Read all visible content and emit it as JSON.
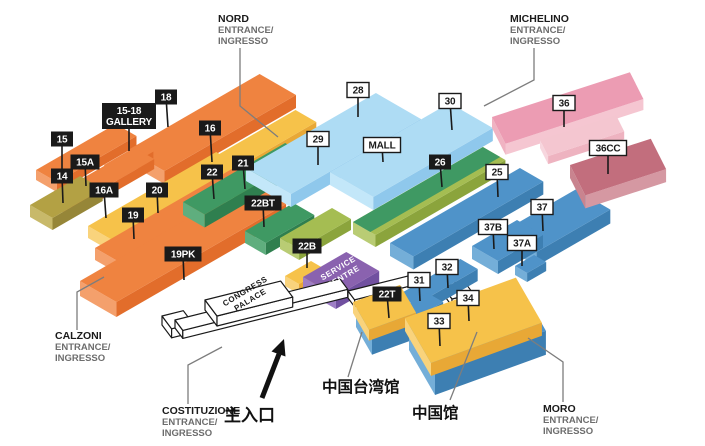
{
  "title": "Exhibition grounds isometric map",
  "halls": {
    "15": "15",
    "15A": "15A",
    "14": "14",
    "16": "16",
    "16A": "16A",
    "18": "18",
    "19": "19",
    "20": "20",
    "19PK": "19PK",
    "22": "22",
    "21": "21",
    "22BT": "22BT",
    "22B": "22B",
    "26": "26",
    "28": "28",
    "29": "29",
    "30": "30",
    "MALL": "MALL",
    "25": "25",
    "36": "36",
    "36CC": "36CC",
    "37": "37",
    "37B": "37B",
    "37A": "37A",
    "31": "31",
    "32": "32",
    "33": "33",
    "34": "34",
    "22T": "22T",
    "GALLERY_L1": "15-18",
    "GALLERY_L2": "GALLERY"
  },
  "entrances": {
    "nord": {
      "name": "NORD",
      "line1": "ENTRANCE/",
      "line2": "INGRESSO"
    },
    "michelino": {
      "name": "MICHELINO",
      "line1": "ENTRANCE/",
      "line2": "INGRESSO"
    },
    "calzoni": {
      "name": "CALZONI",
      "line1": "ENTRANCE/",
      "line2": "INGRESSO"
    },
    "costituzione": {
      "name": "COSTITUZIONE",
      "line1": "ENTRANCE/",
      "line2": "INGRESSO"
    },
    "moro": {
      "name": "MORO",
      "line1": "ENTRANCE/",
      "line2": "INGRESSO"
    }
  },
  "labels_cn": {
    "main_entrance": "主入口",
    "taiwan_pavilion": "中国台湾馆",
    "china_pavilion": "中国馆"
  },
  "buildings": {
    "congress_l1": "CONGRESS",
    "congress_l2": "PALACE",
    "service_l1": "SERVICE",
    "service_l2": "CENTRE"
  },
  "colors": {
    "orange": {
      "top": "#ef8340",
      "end": "#f4a06c",
      "front": "#e26d2b"
    },
    "yellow": {
      "top": "#f6c24a",
      "end": "#f9d37c",
      "front": "#e8a836"
    },
    "olive": {
      "top": "#b3a144",
      "end": "#c8b96a",
      "front": "#968638"
    },
    "dgreen": {
      "top": "#3f9963",
      "end": "#5fae7e",
      "front": "#2f7f4f"
    },
    "lgreen": {
      "top": "#a5bd52",
      "end": "#b9cc74",
      "front": "#8ba43c"
    },
    "lblue": {
      "top": "#aedcf4",
      "end": "#c3e7f9",
      "front": "#8fc8ec"
    },
    "steel": {
      "top": "#4f93c9",
      "end": "#74aed8",
      "front": "#3d7fb2"
    },
    "pink": {
      "top": "#ec9cb3",
      "end": "#f0b3c2",
      "front": "#f5c6d1"
    },
    "palepink": {
      "top": "#f4c6d0",
      "end": "#f7d6de",
      "front": "#eeb3c0"
    },
    "rose": {
      "top": "#c26e7d",
      "end": "#c9848f",
      "front": "#d598a2"
    },
    "purple": {
      "top": "#8a62af",
      "end": "#9e7ec5",
      "front": "#7150a0"
    },
    "white": {
      "top": "#ffffff",
      "end": "#ffffff",
      "front": "#ffffff"
    },
    "ink": "#1a1a1a",
    "leader": "#7d7d7d",
    "subtext": "#6d6d6d",
    "bg": "#ffffff"
  }
}
